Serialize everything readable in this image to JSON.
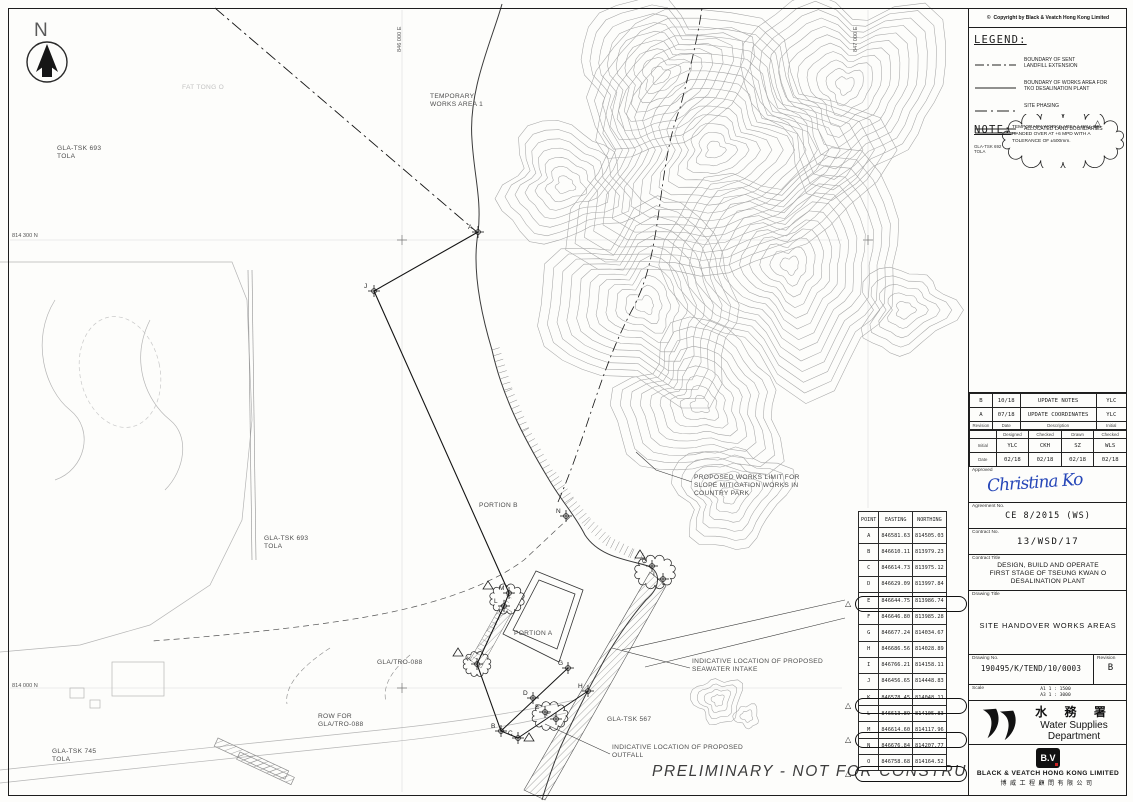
{
  "sheet": {
    "north_label": "N",
    "preliminary_note": "PRELIMINARY  -  NOT FOR CONSTRUCTION"
  },
  "titleblock": {
    "copyright": "Copyright by Black & Veatch Hong Kong Limited",
    "legend": {
      "heading": "LEGEND:",
      "items": [
        {
          "style": "dashdot",
          "label": "BOUNDARY OF SENT\nLANDFILL EXTENSION"
        },
        {
          "style": "solid",
          "label": "BOUNDARY OF WORKS AREA FOR\nTKO DESALINATION PLANT"
        },
        {
          "style": "phasing",
          "label": "SITE PHASING"
        },
        {
          "style": "double",
          "label": "ALLOCATED LAND BOUNDARIES",
          "sublabel": "GLA-TSK 692\nTOLA"
        }
      ]
    },
    "note": {
      "heading": "NOTE:",
      "text": "TEMPORARY WORKS AREA 1 WILL BE HANDED OVER AT +6 MPD WITH A TOLERANCE OF ±500mm."
    },
    "revisions": {
      "columns": [
        "Revision",
        "Date",
        "Description",
        "Initial"
      ],
      "rows": [
        [
          "B",
          "10/18",
          "UPDATE NOTES",
          "YLC"
        ],
        [
          "A",
          "07/18",
          "UPDATE COORDINATES",
          "YLC"
        ]
      ]
    },
    "signoff": {
      "columns": [
        "Designed",
        "Checked",
        "Drawn",
        "Checked"
      ],
      "initial_label": "Initial",
      "date_label": "Date",
      "initials": [
        "YLC",
        "CKH",
        "SZ",
        "WLS"
      ],
      "dates": [
        "02/18",
        "02/18",
        "02/18",
        "02/18"
      ]
    },
    "approved_label": "Approved",
    "signature": "Christina Ko",
    "agreement": {
      "label": "Agreement No.",
      "value": "CE 8/2015 (WS)"
    },
    "contract_no": {
      "label": "Contract No.",
      "value": "13/WSD/17"
    },
    "contract_title": {
      "label": "Contract Title",
      "value": "DESIGN, BUILD AND OPERATE\nFIRST STAGE OF TSEUNG KWAN O\nDESALINATION PLANT"
    },
    "drawing_title": {
      "label": "Drawing Title",
      "value": "SITE HANDOVER WORKS AREAS"
    },
    "drawing_no": {
      "label": "Drawing No.",
      "value": "190495/K/TEND/10/0003",
      "revision_label": "Revision",
      "revision": "B"
    },
    "scale": {
      "label": "Scale",
      "values": [
        "A1 1 : 1500",
        "A3 1 : 3000"
      ]
    },
    "wsd": {
      "chinese": "水 務 署",
      "english_1": "Water Supplies",
      "english_2": "Department"
    },
    "bv": {
      "logo": "B.V",
      "name": "BLACK & VEATCH HONG KONG LIMITED",
      "chinese": "博威工程顧問有限公司"
    }
  },
  "coordinate_table": {
    "columns": [
      "POINT",
      "EASTING",
      "NORTHING"
    ],
    "rows": [
      {
        "point": "A",
        "easting": "846581.63",
        "northing": "814505.03",
        "flagged": false
      },
      {
        "point": "B",
        "easting": "846610.11",
        "northing": "813979.23",
        "flagged": false
      },
      {
        "point": "C",
        "easting": "846614.73",
        "northing": "813975.12",
        "flagged": false
      },
      {
        "point": "D",
        "easting": "846629.09",
        "northing": "813997.84",
        "flagged": false
      },
      {
        "point": "E",
        "easting": "846644.75",
        "northing": "813986.74",
        "flagged": true
      },
      {
        "point": "F",
        "easting": "846646.80",
        "northing": "813985.28",
        "flagged": false
      },
      {
        "point": "G",
        "easting": "846677.24",
        "northing": "814034.67",
        "flagged": false
      },
      {
        "point": "H",
        "easting": "846686.56",
        "northing": "814028.89",
        "flagged": false
      },
      {
        "point": "I",
        "easting": "846766.21",
        "northing": "814158.11",
        "flagged": false
      },
      {
        "point": "J",
        "easting": "846456.65",
        "northing": "814448.83",
        "flagged": false
      },
      {
        "point": "K",
        "easting": "846578.45",
        "northing": "814048.11",
        "flagged": true
      },
      {
        "point": "L",
        "easting": "846613.89",
        "northing": "814105.83",
        "flagged": false
      },
      {
        "point": "M",
        "easting": "846614.60",
        "northing": "814117.96",
        "flagged": true
      },
      {
        "point": "N",
        "easting": "846676.84",
        "northing": "814207.77",
        "flagged": false
      },
      {
        "point": "O",
        "easting": "846758.68",
        "northing": "814164.52",
        "flagged": true
      }
    ]
  },
  "map": {
    "grid_labels": [
      {
        "text": "814 300 N",
        "x": 12,
        "y": 233,
        "vert": false
      },
      {
        "text": "814 000 N",
        "x": 12,
        "y": 683,
        "vert": false
      },
      {
        "text": "846 000 E",
        "x": 397,
        "y": 52,
        "vert": true
      },
      {
        "text": "847 000 E",
        "x": 853,
        "y": 52,
        "vert": true
      }
    ],
    "labels": [
      {
        "text": "TEMPORARY\nWORKS AREA 1",
        "x": 430,
        "y": 93
      },
      {
        "text": "PORTION B",
        "x": 479,
        "y": 502
      },
      {
        "text": "PORTION A",
        "x": 514,
        "y": 630
      },
      {
        "text": "GLA-TSK 693\nTOLA",
        "x": 57,
        "y": 145
      },
      {
        "text": "GLA-TSK 693\nTOLA",
        "x": 264,
        "y": 535
      },
      {
        "text": "GLA/TRO-088",
        "x": 377,
        "y": 659
      },
      {
        "text": "ROW FOR\nGLA/TRO-088",
        "x": 318,
        "y": 713
      },
      {
        "text": "GLA-TSK 745\nTOLA",
        "x": 52,
        "y": 748
      },
      {
        "text": "GLA-TSK 567",
        "x": 607,
        "y": 716
      },
      {
        "text": "PROPOSED WORKS LIMIT FOR\nSLOPE MITIGATION WORKS IN\nCOUNTRY PARK",
        "x": 694,
        "y": 474
      },
      {
        "text": "INDICATIVE LOCATION OF PROPOSED\nSEAWATER INTAKE",
        "x": 692,
        "y": 658
      },
      {
        "text": "INDICATIVE LOCATION OF PROPOSED\nOUTFALL",
        "x": 612,
        "y": 744
      },
      {
        "text": "FAT TONG O",
        "x": 182,
        "y": 84,
        "faint": true
      }
    ],
    "points": [
      {
        "letter": "A",
        "x": 478,
        "y": 232
      },
      {
        "letter": "J",
        "x": 374,
        "y": 291
      },
      {
        "letter": "N",
        "x": 566,
        "y": 516
      },
      {
        "letter": "O",
        "x": 652,
        "y": 566
      },
      {
        "letter": "I",
        "x": 663,
        "y": 579
      },
      {
        "letter": "M",
        "x": 509,
        "y": 593
      },
      {
        "letter": "L",
        "x": 504,
        "y": 606
      },
      {
        "letter": "K",
        "x": 477,
        "y": 664
      },
      {
        "letter": "B",
        "x": 501,
        "y": 731
      },
      {
        "letter": "C",
        "x": 518,
        "y": 738
      },
      {
        "letter": "D",
        "x": 533,
        "y": 698
      },
      {
        "letter": "E",
        "x": 545,
        "y": 712
      },
      {
        "letter": "F",
        "x": 556,
        "y": 719
      },
      {
        "letter": "G",
        "x": 568,
        "y": 668
      },
      {
        "letter": "H",
        "x": 588,
        "y": 691
      }
    ],
    "clouds": [
      {
        "cx": 655,
        "cy": 572,
        "rx": 18,
        "ry": 13
      },
      {
        "cx": 507,
        "cy": 599,
        "rx": 15,
        "ry": 12
      },
      {
        "cx": 477,
        "cy": 664,
        "rx": 12,
        "ry": 10
      },
      {
        "cx": 550,
        "cy": 716,
        "rx": 16,
        "ry": 11
      }
    ],
    "triangles": [
      {
        "x": 640,
        "y": 550
      },
      {
        "x": 488,
        "y": 581
      },
      {
        "x": 458,
        "y": 648
      },
      {
        "x": 529,
        "y": 733
      }
    ]
  }
}
